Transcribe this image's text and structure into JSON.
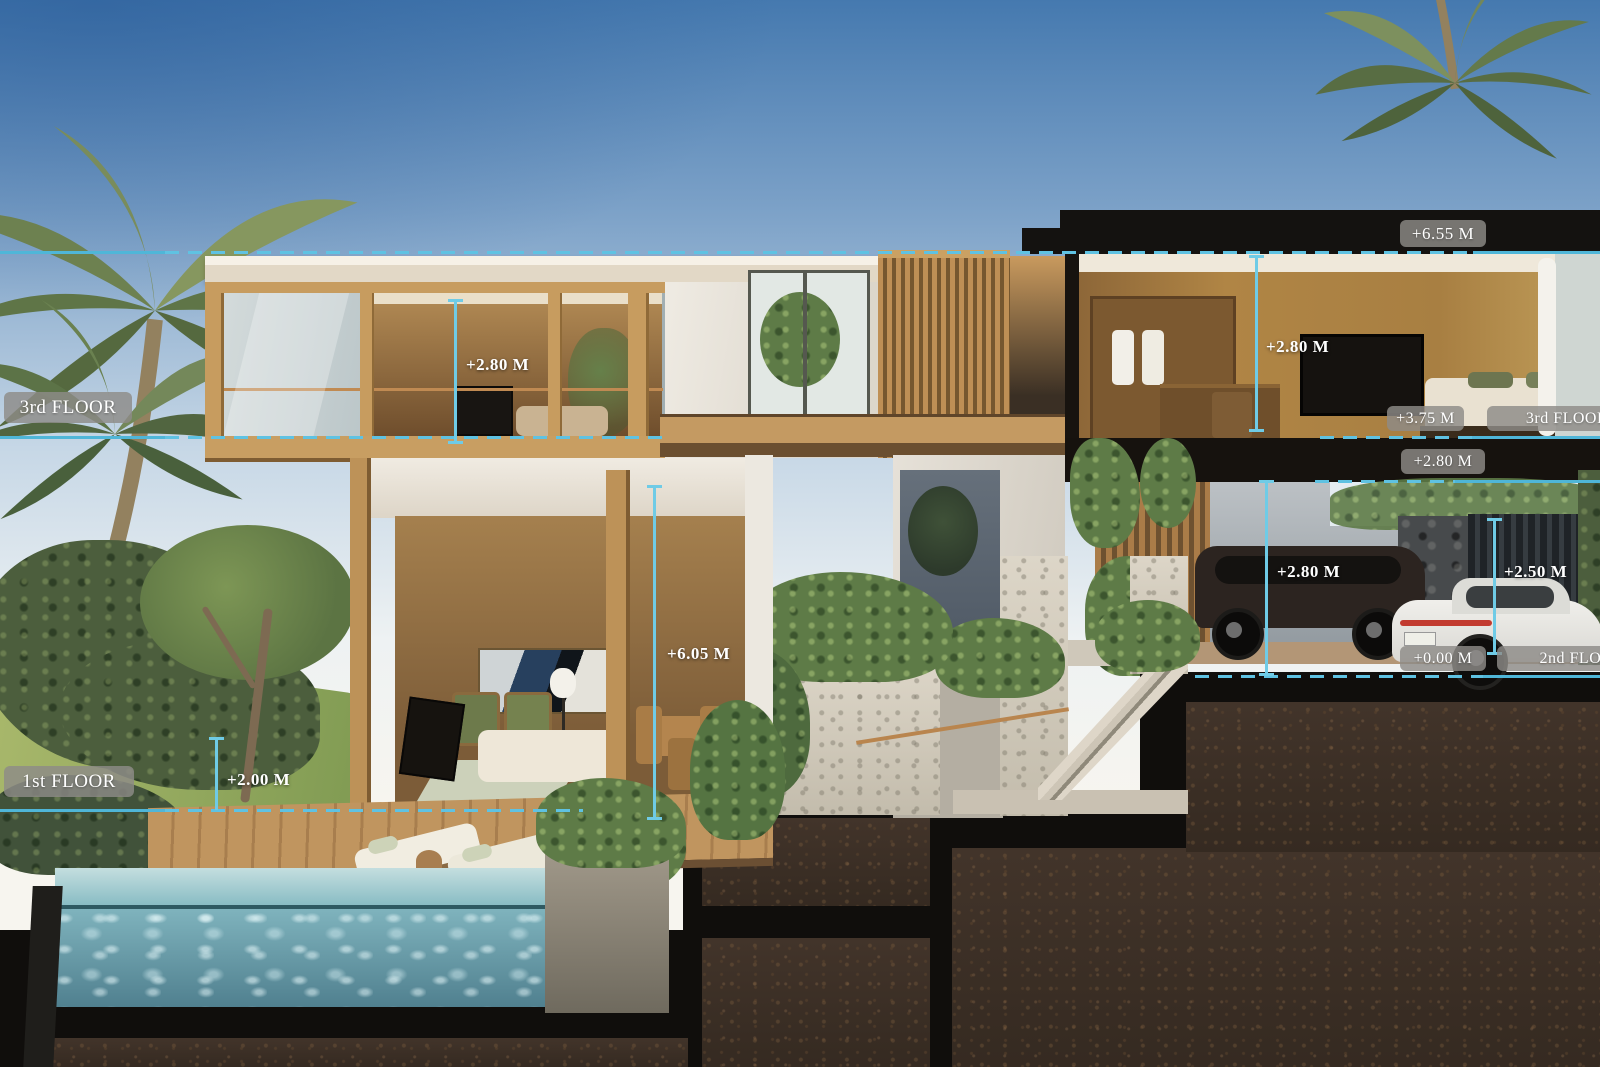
{
  "scene": {
    "description": "Architectural cross-section rendering of a tropical multi-level villa with pool terrace, garden, staircase and garage cut through the hillside",
    "accent_line_color": "#5fc2e2",
    "pill_background": "rgba(141,139,135,0.82)",
    "soil_color": "#3a2d22",
    "sky_top_color": "#4579af"
  },
  "labels": {
    "third_floor_left": "3rd FLOOR",
    "first_floor_left": "1st FLOOR",
    "elev_roof": "+6.55 M",
    "elev_third_floor": "+3.75 M",
    "third_floor_right": "3rd FLOOR",
    "elev_slab": "+2.80 M",
    "elev_ground": "+0.00 M",
    "second_floor_right": "2nd FLOOR",
    "height_third_room": "+2.80 M",
    "height_living_void": "+6.05 M",
    "height_bedroom": "+2.80 M",
    "height_garage": "+2.80 M",
    "height_gate": "+2.50 M",
    "height_garden": "+2.00 M"
  }
}
